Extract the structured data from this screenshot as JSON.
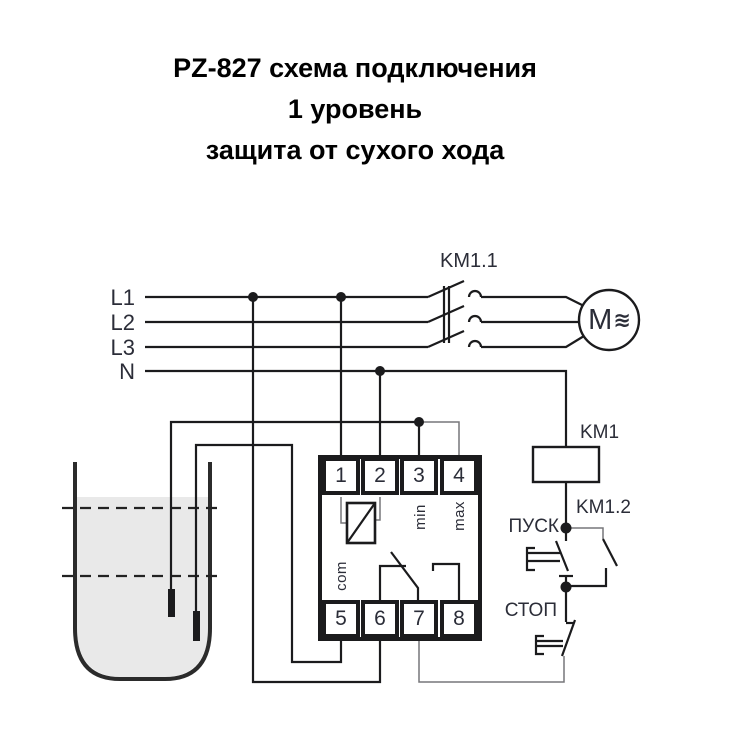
{
  "title": {
    "line1": "PZ-827 схема подключения",
    "line2": "1 уровень",
    "line3": "защита от сухого хода"
  },
  "power_lines": {
    "l1": "L1",
    "l2": "L2",
    "l3": "L3",
    "n": "N"
  },
  "contactor": {
    "main_contacts_label": "KM1.1",
    "coil_label": "KM1",
    "aux_contact_label": "KM1.2"
  },
  "motor": {
    "label": "M",
    "wave": "≋"
  },
  "relay": {
    "terminals_top": [
      "1",
      "2",
      "3",
      "4"
    ],
    "terminals_bottom": [
      "5",
      "6",
      "7",
      "8"
    ],
    "internal_labels": {
      "min": "min",
      "max": "max",
      "com": "com"
    }
  },
  "buttons": {
    "start": "ПУСК",
    "stop": "СТОП"
  },
  "colors": {
    "line": "#1b1b1d",
    "thin_line": "#77777a",
    "text": "#2b2d38",
    "water": "#e9e9e9",
    "background": "#ffffff"
  }
}
